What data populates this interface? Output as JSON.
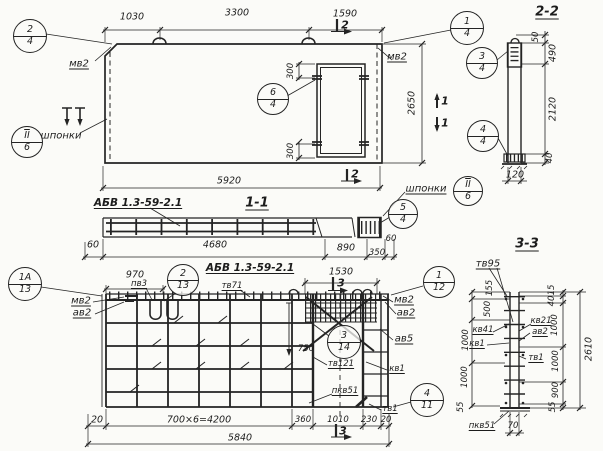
{
  "plan": {
    "dims": {
      "seg1": "1030",
      "seg2": "3300",
      "seg3": "1590",
      "total": "5920",
      "height": "2650",
      "anchor_top": "300",
      "anchor_bottom": "300"
    },
    "labels": {
      "mv2_left": "мв2",
      "mv2_right": "мв2",
      "shponki": "шпонки"
    },
    "marks": {
      "cut2_top": "2",
      "cut2_bottom": "2",
      "cut1_upper": "1",
      "cut1_lower": "1"
    },
    "callouts": {
      "c24": {
        "n": "2",
        "d": "4"
      },
      "c14": {
        "n": "1",
        "d": "4"
      },
      "c64": {
        "n": "6",
        "d": "4"
      },
      "key": {
        "n": "II",
        "d": "6"
      }
    }
  },
  "section22": {
    "title": "2-2",
    "dims": {
      "d50": "50",
      "d490": "490",
      "d2120": "2120",
      "d40": "40",
      "d120": "120"
    },
    "callouts": {
      "c34": {
        "n": "3",
        "d": "4"
      },
      "c44": {
        "n": "4",
        "d": "4"
      }
    }
  },
  "section11": {
    "title": "1-1",
    "mark": "АБВ 1.3-59-2.1",
    "shponki": "шпонки",
    "dims": {
      "d60l": "60",
      "d4680": "4680",
      "d890": "890",
      "d350": "350",
      "d60r": "60"
    },
    "callouts": {
      "c54": {
        "n": "5",
        "d": "4"
      },
      "key": {
        "n": "II",
        "d": "6"
      }
    }
  },
  "rplan": {
    "title": "АБВ 1.3-59-2.1",
    "dims": {
      "d970": "970",
      "d1530": "1530",
      "d750": "750",
      "d20l": "20",
      "d4200": "700×6=4200",
      "d360": "360",
      "d1010": "1010",
      "d230": "230",
      "d20r": "20",
      "total": "5840"
    },
    "labels": {
      "pv3": "пв3",
      "tv71": "тв71",
      "mv2_left": "мв2",
      "av2_left": "ав2",
      "mv2_right": "мв2",
      "av2_right": "ав2",
      "av5": "ав5",
      "tv121": "тв121",
      "kv1": "кв1",
      "pkv51": "пкв51",
      "tv1": "тв1"
    },
    "marks": {
      "cut3_top": "3",
      "cut3_bottom": "3"
    },
    "callouts": {
      "c1a13": {
        "n": "1А",
        "d": "13"
      },
      "c213": {
        "n": "2",
        "d": "13"
      },
      "c112": {
        "n": "1",
        "d": "12"
      },
      "c314": {
        "n": "3",
        "d": "14"
      },
      "c411": {
        "n": "4",
        "d": "11"
      }
    }
  },
  "section33": {
    "title": "3-3",
    "labels": {
      "tv95": "тв95",
      "kv41": "кв41",
      "kv1": "кв1",
      "kv21": "кв21",
      "av2": "ав2",
      "tv1": "тв1",
      "pkv51": "пкв51"
    },
    "dims": {
      "left": [
        "155",
        "500",
        "1000",
        "1000",
        "55"
      ],
      "right": [
        "15",
        "40",
        "1000",
        "1000",
        "900",
        "55"
      ],
      "total": "2610",
      "base": "70"
    }
  }
}
